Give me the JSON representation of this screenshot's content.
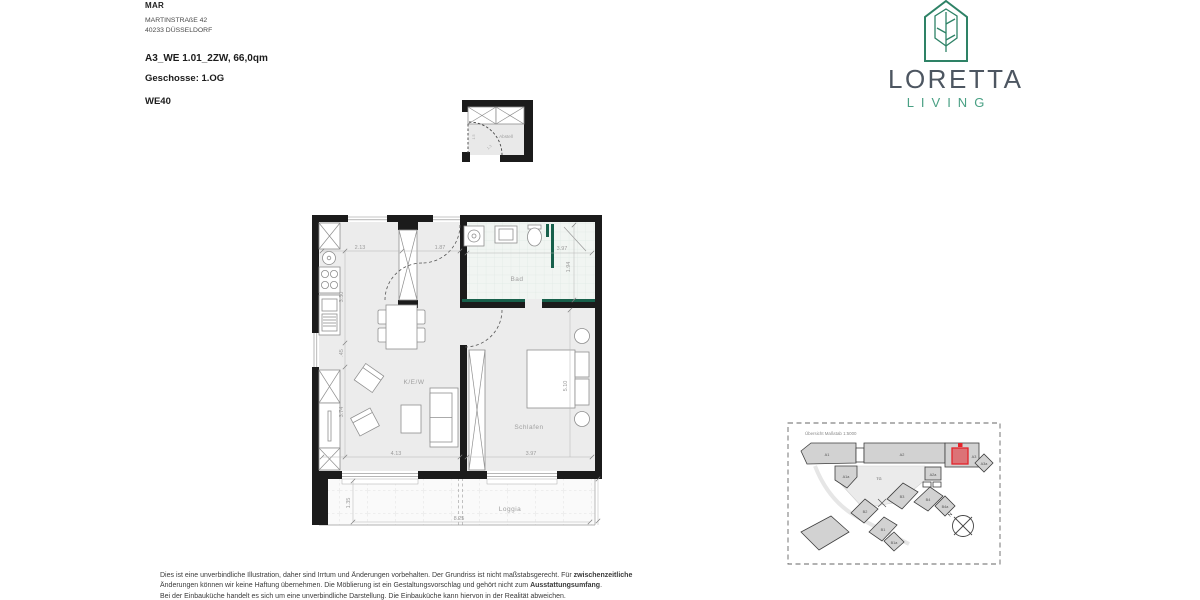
{
  "header": {
    "company": "MAR",
    "address_line1": "MARTINSTRAßE 42",
    "address_line2": "40233 DÜSSELDORF",
    "unit_title": "A3_WE 1.01_2ZW, 66,0qm",
    "floor_label": "Geschosse: 1.OG",
    "unit_code": "WE40"
  },
  "logo": {
    "name": "LORETTA",
    "sub": "LIVING",
    "green": "#2e8266",
    "dark": "#4d5661"
  },
  "floorplan": {
    "rooms": {
      "kitchen_living": "K/E/W",
      "sleeping": "Schlafen",
      "bath": "Bad",
      "loggia": "Loggia",
      "storage": "Abstell"
    },
    "dims": {
      "kitchen_width": "2.13",
      "entry_width": "1.87",
      "kitchen_height": "3.30",
      "bath_width": "3.97",
      "bath_height": "1.94",
      "wall_offset": ".45",
      "living_height": "3.74",
      "living_width": "4.13",
      "sleeping_width": "3.97",
      "sleeping_height": "5.10",
      "loggia_depth": "1.35",
      "loggia_width": "8.25",
      "storage_height": "1.5",
      "storage_door": "1.3"
    },
    "accent_green": "#17604b",
    "wall_color": "#1b1b1b"
  },
  "siteplan": {
    "title": "Übersicht Maßstab 1:5000",
    "north_label": "N",
    "highlight_color": "#e3242b",
    "labels": {
      "a1": "A1",
      "a1a": "A1a",
      "a2": "A2",
      "a2a": "A2a",
      "a3": "A3",
      "a3a": "A3a",
      "tg": "TG",
      "b1": "B1",
      "b1a": "B1a",
      "b2": "B2",
      "b3": "B3",
      "b4": "B4",
      "b4a": "B4a"
    }
  },
  "disclaimer": {
    "line1_pre": "Dies ist eine unverbindliche Illustration, daher sind Irrtum und Änderungen vorbehalten. Der Grundriss ist nicht maßstabsgerecht. Für ",
    "line1_bold": "zwischenzeitliche",
    "line2_pre": "Änderungen können wir keine Haftung übernehmen. Die Möblierung ist ein Gestaltungsvorschlag und gehört nicht zum ",
    "line2_bold": "Ausstattungsumfang",
    "line2_post": ".",
    "line3": "Bei der Einbauküche handelt es sich um eine unverbindliche Darstellung. Die Einbauküche kann hiervon in der Realität abweichen."
  }
}
